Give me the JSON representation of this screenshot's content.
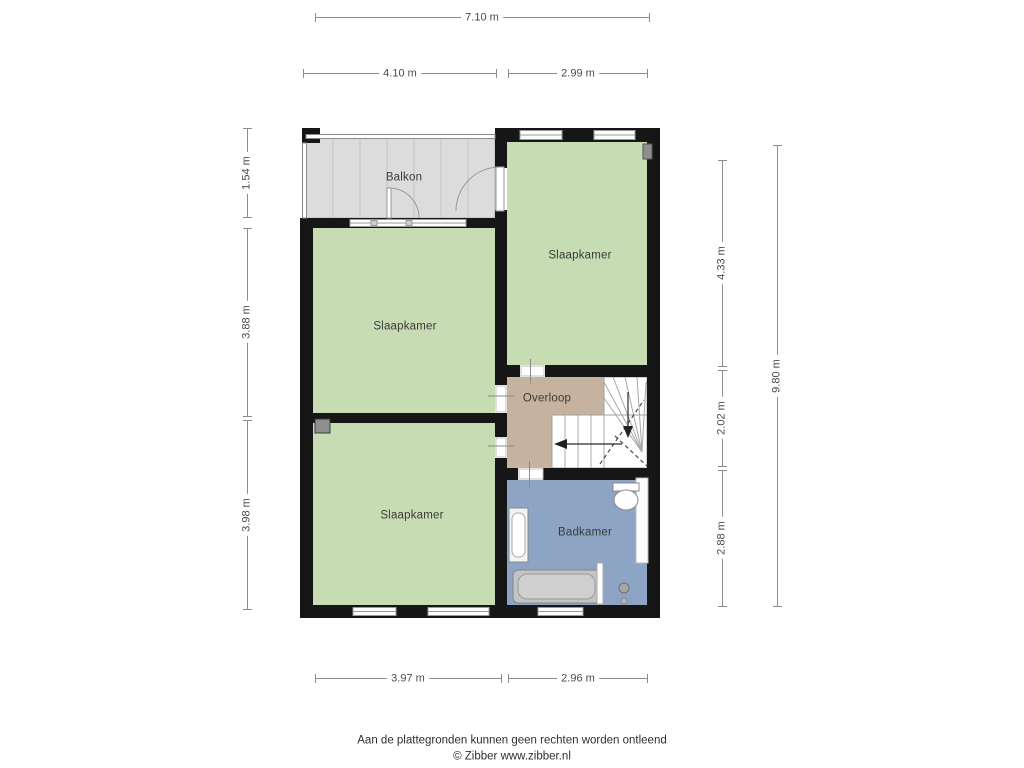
{
  "plan": {
    "rooms": {
      "balkon": {
        "label": "Balkon",
        "color": "#dcdcdc"
      },
      "slaapkamer_rechts": {
        "label": "Slaapkamer",
        "color": "#c8dcb4"
      },
      "slaapkamer_midden": {
        "label": "Slaapkamer",
        "color": "#c8dcb4"
      },
      "slaapkamer_onder": {
        "label": "Slaapkamer",
        "color": "#c8dcb4"
      },
      "overloop": {
        "label": "Overloop",
        "color": "#c6b39f"
      },
      "badkamer": {
        "label": "Badkamer",
        "color": "#8da4c4"
      }
    },
    "wall_color": "#161616"
  },
  "dimensions": {
    "top_total": "7.10 m",
    "top_left": "4.10 m",
    "top_right": "2.99 m",
    "left_top": "1.54 m",
    "left_middle": "3.88 m",
    "left_bottom": "3.98 m",
    "right_top": "4.33 m",
    "right_middle": "2.02 m",
    "right_bottom": "2.88 m",
    "right_total": "9.80 m",
    "bottom_left": "3.97 m",
    "bottom_right": "2.96 m"
  },
  "footer": {
    "disclaimer": "Aan de plattegronden kunnen geen rechten worden ontleend",
    "copyright": "© Zibber www.zibber.nl"
  }
}
